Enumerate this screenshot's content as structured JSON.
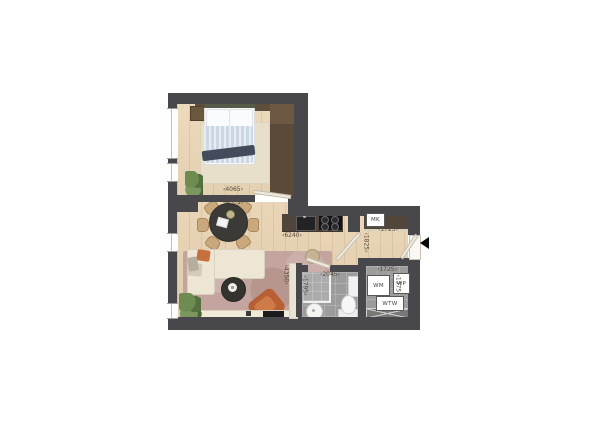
{
  "floorplan": {
    "dimensions": {
      "bedroom_width": "‹4065›",
      "living_width_top": "‹4065›",
      "bedroom_depth": "‹3300›",
      "kitchen_width": "‹6240›",
      "living_depth": "‹4350›",
      "bathroom_width": "‹2045›",
      "bathroom_depth": "‹1795›",
      "hall_width": "‹1725›",
      "hall_depth": "‹1825›",
      "tech_width": "‹1725›",
      "tech_depth": "‹1375›"
    },
    "labels": {
      "meter_cupboard": "MK",
      "washing_machine": "WM",
      "heat_pump": "WP",
      "heat_recovery_unit": "WTW"
    },
    "colors": {
      "wall": "#48474b",
      "wood_floor": "#e9d4b3",
      "tile_floor": "#9c9c9c",
      "rug_living": "#c3a49e",
      "rug_bedroom": "#e8dfca",
      "sofa": "#ede6d5",
      "accent_terracotta": "#c5693c",
      "plant_green": "#5e7c49",
      "duvet_blue": "#ccd7e4"
    }
  }
}
